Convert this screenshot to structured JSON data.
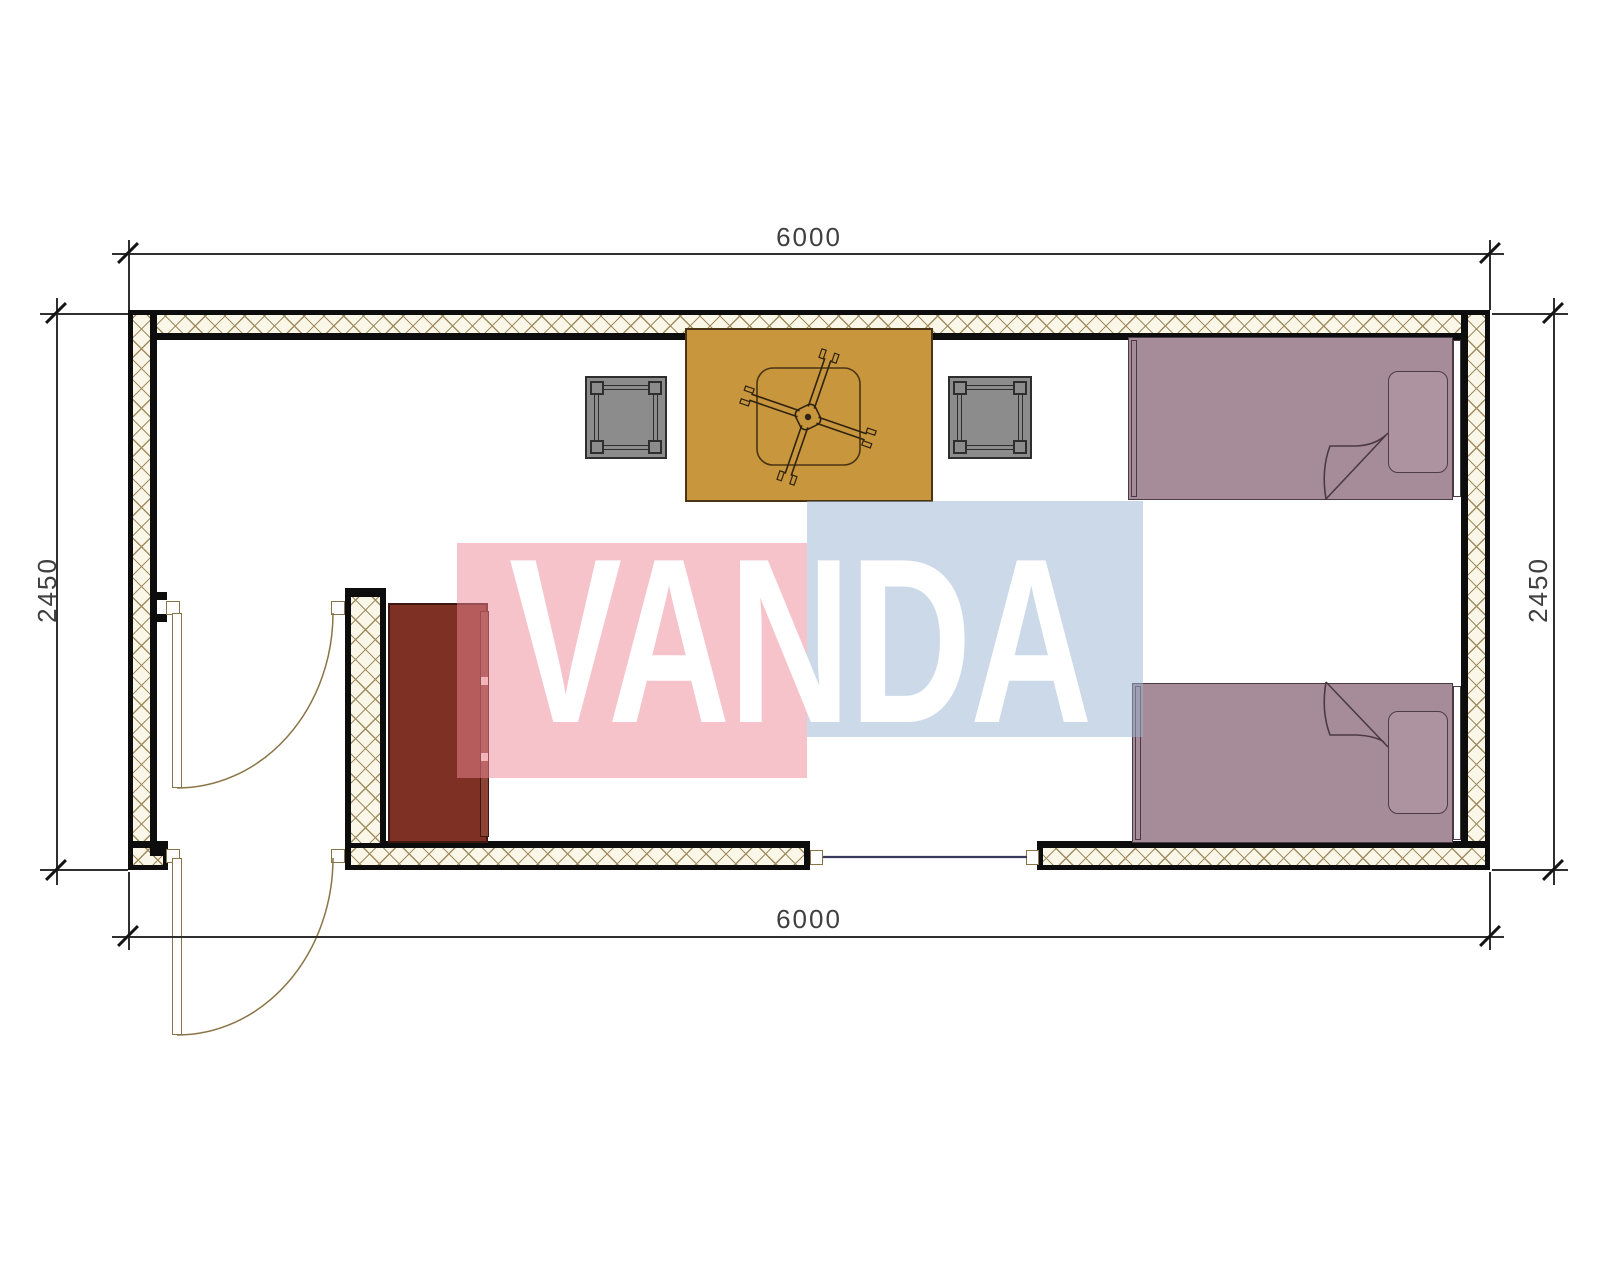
{
  "title": "container-room-floor-plan",
  "dimensions": {
    "top": "6000",
    "bottom": "6000",
    "left": "2450",
    "right": "2450"
  },
  "watermark": {
    "text": "VANDA"
  },
  "colors": {
    "wall_hatch_bg": "#faf6e8",
    "wall_hatch_line": "#a08c5f",
    "wall_outline": "#0d0d0d",
    "table": "#c8963c",
    "stool": "#8c8c8c",
    "bed": "#a68c99",
    "cabinet": "#7d3023",
    "cabinet_strip": "#8d4434",
    "door": "#8a7447",
    "window_line": "#3a3a5e",
    "dim_line": "#2f2f2f",
    "dim_text": "#3f3f3f",
    "tick": "#141414",
    "wm_pink": "rgba(239,135,151,0.5)",
    "wm_blue": "rgba(153,179,209,0.5)",
    "wm_text": "#ffffff"
  },
  "furniture": {
    "table": "dining-table",
    "fan": "ceiling-fan",
    "stools": [
      "stool-left",
      "stool-right"
    ],
    "beds": [
      "bed-top",
      "bed-bottom"
    ],
    "cabinet": "cabinet",
    "window": "window-bottom-wall",
    "doors": [
      "interior-door",
      "exterior-door"
    ]
  }
}
